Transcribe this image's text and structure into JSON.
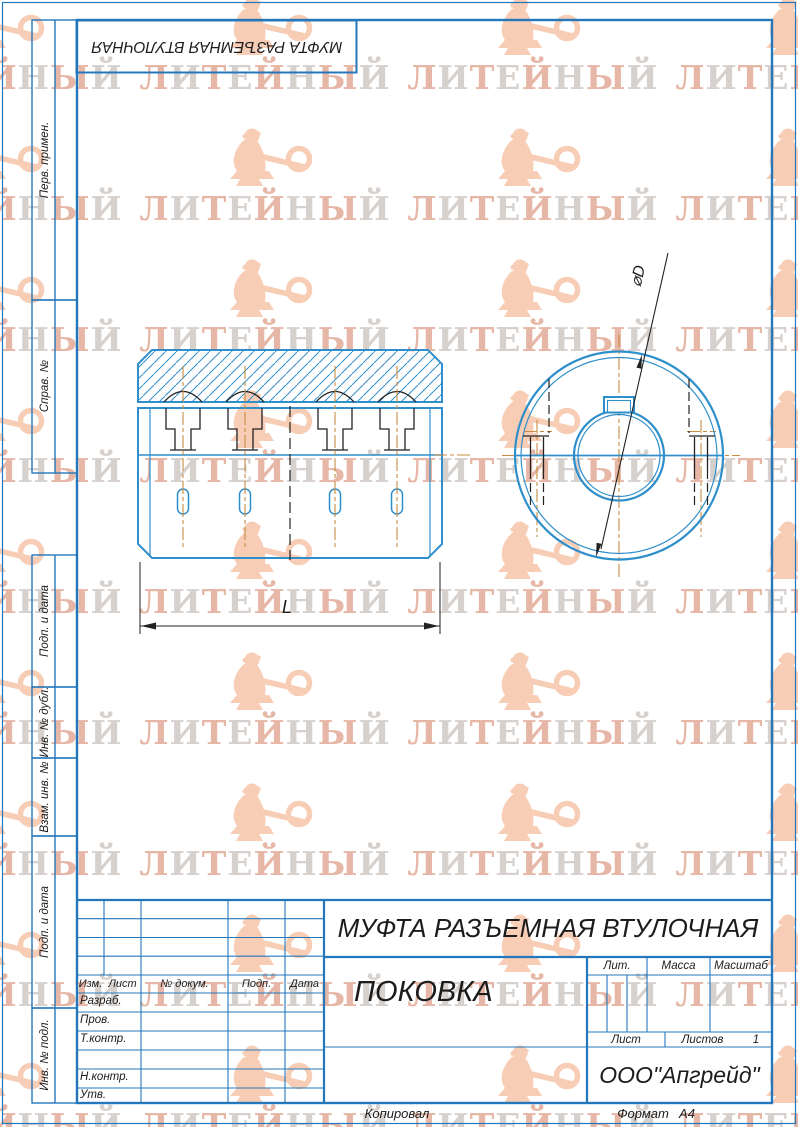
{
  "page": {
    "stamp_top": "МУФТА РАЗЪЕМНАЯ ВТУЛОЧНАЯ",
    "copied_label": "Копировал",
    "format_label": "Формат",
    "format_value": "А4"
  },
  "watermark": {
    "text": "ЛИТЕЙНЫЙ",
    "color_a": "#dd9b84",
    "color_b": "#c8c0bc",
    "figure_color": "#f8cdb6"
  },
  "side_labels": [
    "Перв. примен.",
    "Справ. №",
    "Подп. и дата",
    "Инв. № дубл.",
    "Взам. инв. №",
    "Подп. и дата",
    "Инв. № подл."
  ],
  "title_block": {
    "doc_title": "МУФТА РАЗЪЕМНАЯ ВТУЛОЧНАЯ",
    "doc_subtitle": "ПОКОВКА",
    "company": "ООО\"Апгрейд\"",
    "columns": [
      "Изм.",
      "Лист",
      "№ докум.",
      "Подп.",
      "Дата"
    ],
    "rows": [
      "Разраб.",
      "Пров.",
      "Т.контр.",
      "Н.контр.",
      "Утв."
    ],
    "lit_label": "Лит.",
    "mass_label": "Масса",
    "scale_label": "Масштаб",
    "sheet_label": "Лист",
    "sheets_label": "Листов",
    "sheets_value": "1"
  },
  "drawing": {
    "dim_length": "L",
    "dim_diameter": "⌀D"
  },
  "colors": {
    "frame_blue": "#2477bb",
    "drawing_blue": "#2f8fca",
    "centerline_orange": "#c78c42",
    "line_black": "#222222"
  }
}
